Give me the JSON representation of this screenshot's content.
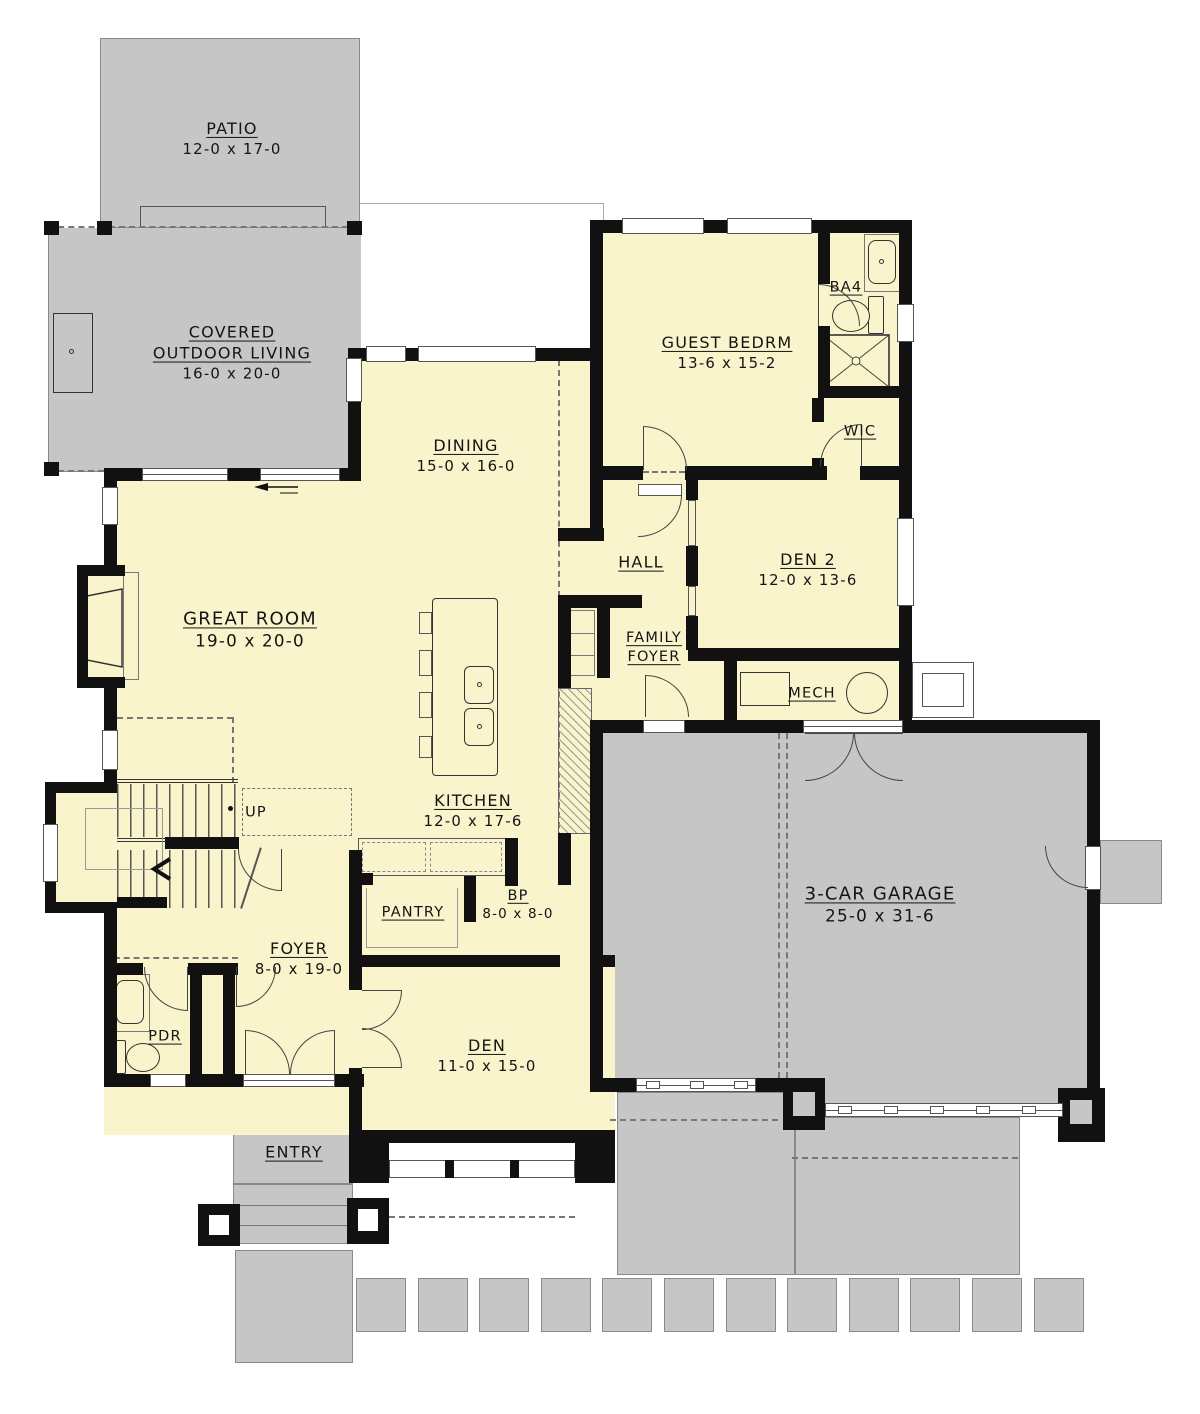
{
  "plan_title": "First floor plan",
  "colors": {
    "interior": "#FAF4CC",
    "outdoor": "#C6C6C6",
    "wall": "#111111"
  },
  "rooms": {
    "patio": {
      "name": "PATIO",
      "dims": "12-0 x 17-0"
    },
    "col": {
      "name1": "COVERED",
      "name2": "OUTDOOR LIVING",
      "dims": "16-0 x 20-0"
    },
    "guest": {
      "name": "GUEST BEDRM",
      "dims": "13-6 x 15-2"
    },
    "ba4": {
      "name": "BA4"
    },
    "wic": {
      "name": "WIC"
    },
    "dining": {
      "name": "DINING",
      "dims": "15-0 x 16-0"
    },
    "hall": {
      "name": "HALL"
    },
    "den2": {
      "name": "DEN 2",
      "dims": "12-0 x 13-6"
    },
    "great": {
      "name": "GREAT ROOM",
      "dims": "19-0 x 20-0"
    },
    "famfoyer": {
      "name1": "FAMILY",
      "name2": "FOYER"
    },
    "mech": {
      "name": "MECH"
    },
    "kitchen": {
      "name": "KITCHEN",
      "dims": "12-0 x 17-6"
    },
    "bp": {
      "name": "BP",
      "dims": "8-0 x 8-0"
    },
    "pantry": {
      "name": "PANTRY"
    },
    "foyer": {
      "name": "FOYER",
      "dims": "8-0 x 19-0"
    },
    "pdr": {
      "name": "PDR"
    },
    "den": {
      "name": "DEN",
      "dims": "11-0 x 15-0"
    },
    "entry": {
      "name": "ENTRY"
    },
    "garage": {
      "name": "3-CAR GARAGE",
      "dims": "25-0 x 31-6"
    },
    "stairs": {
      "direction": "UP"
    }
  }
}
